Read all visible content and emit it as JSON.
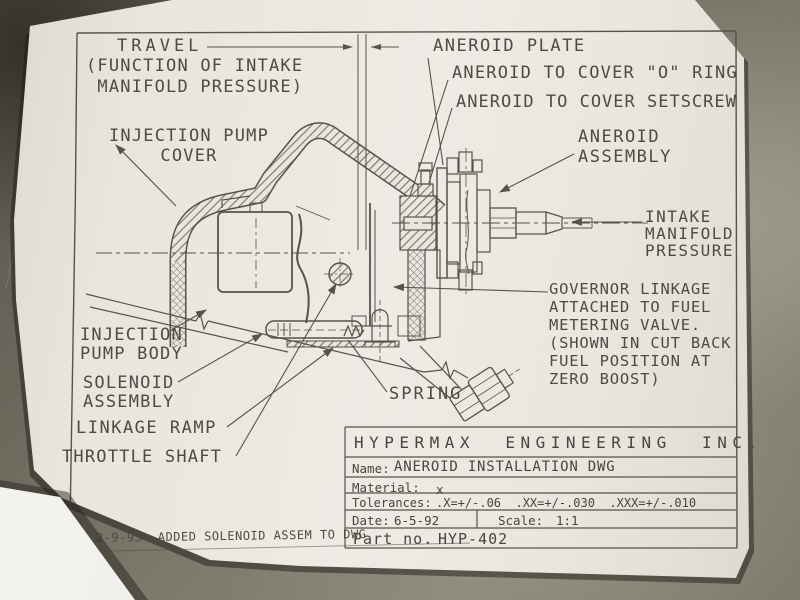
{
  "photo": {
    "surface_description": "dark mottled metal workbench",
    "background_color": "#6b695c",
    "paper_color": "#e9e6df",
    "ink_color": "#55534a"
  },
  "labels": {
    "travel": "TRAVEL",
    "travel_note": "(FUNCTION OF INTAKE\n MANIFOLD PRESSURE)",
    "aneroid_plate": "ANEROID PLATE",
    "aneroid_o_ring": "ANEROID TO COVER \"O\" RING",
    "aneroid_setscrew": "ANEROID TO COVER SETSCREW",
    "aneroid_assembly": "ANEROID\nASSEMBLY",
    "intake_manifold": "INTAKE\nMANIFOLD\nPRESSURE",
    "governor_linkage": "GOVERNOR LINKAGE\nATTACHED TO FUEL\nMETERING VALVE.\n(SHOWN IN CUT BACK\nFUEL POSITION AT\nZERO BOOST)",
    "injection_pump_cover": "INJECTION PUMP\nCOVER",
    "injection_pump_body": "INJECTION\nPUMP BODY",
    "solenoid_assembly": "SOLENOID\nASSEMBLY",
    "linkage_ramp": "LINKAGE RAMP",
    "throttle_shaft": "THROTTLE SHAFT",
    "spring": "SPRING",
    "revision_note": "2-9-93  ADDED SOLENOID ASSEM TO DWG"
  },
  "title_block": {
    "company": "HYPERMAX  ENGINEERING  INC.",
    "name_label": "Name:",
    "name_value": "ANEROID INSTALLATION DWG",
    "material_label": "Material:",
    "material_value": "x",
    "tolerances_label": "Tolerances:",
    "tolerances_value": ".X=+/-.06  .XX=+/-.030  .XXX=+/-.010",
    "date_label": "Date:",
    "date_value": "6-5-92",
    "scale_label": "Scale:",
    "scale_value": "1:1",
    "part_no_label": "Part no.",
    "part_no_value": "HYP-402"
  }
}
